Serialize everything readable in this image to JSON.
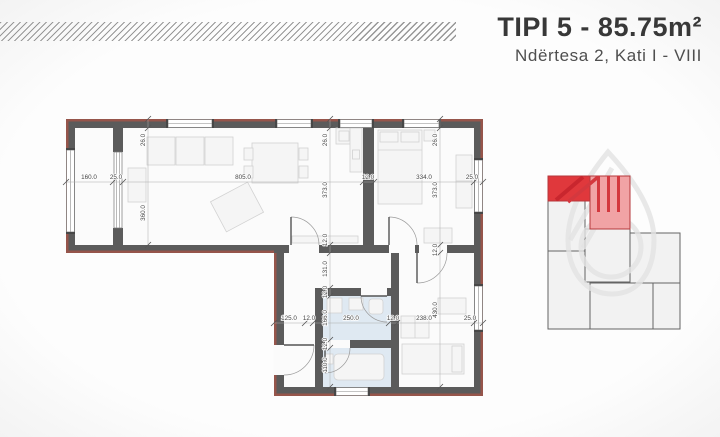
{
  "header": {
    "title": "TIPI 5 - 85.75m²",
    "subtitle": "Ndërtesa 2, Kati I - VIII"
  },
  "floorplan": {
    "dims": {
      "h_top": [
        "160.0",
        "25.0",
        "805.0",
        "12.0",
        "334.0",
        "25.0"
      ],
      "h_bottom": [
        "125.0",
        "12.0",
        "250.0",
        "12.0",
        "238.0",
        "25.0"
      ],
      "v_left": [
        "26.0",
        "360.0"
      ],
      "v_mid": [
        "26.0",
        "373.0",
        "12.0",
        "131.0",
        "12.0",
        "166.0",
        "12.0",
        "110.0"
      ],
      "v_right": [
        "26.0",
        "373.0",
        "12.0",
        "430.0"
      ]
    },
    "colors": {
      "wall": "#5b5b5b",
      "wall_edge": "#96554b",
      "floor": "#fbfbfb",
      "bath_floor": "#dfe9f2"
    }
  },
  "keyplan": {
    "colors": {
      "highlight": "#e0383c",
      "highlight_light": "#f1a3a5",
      "stripe": "#d4383e",
      "stripe_dark": "#c9262e"
    }
  }
}
